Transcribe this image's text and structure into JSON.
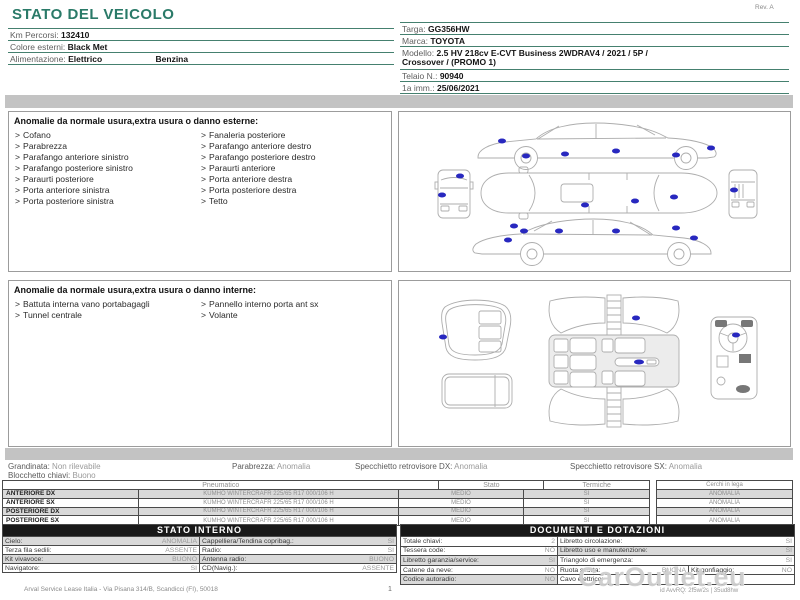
{
  "ui": {
    "bullet": ">"
  },
  "colors": {
    "accent_teal": "#2a7a68",
    "separator_teal": "#45806f",
    "damage_marker_blue": "#2828bf",
    "band_gray": "#c3c3c3",
    "table_header_dark": "#191919",
    "row_gray": "#d9d9d9"
  },
  "header": {
    "title": "STATO DEL VEICOLO",
    "rev": "Rev. A",
    "left_rows": [
      {
        "label": "Km Percorsi:",
        "value": "132410"
      },
      {
        "label": "Colore esterni:",
        "value": "Black Met"
      },
      {
        "label": "Alimentazione:",
        "value": "Elettrico",
        "value2": "Benzina"
      }
    ],
    "right_rows": [
      {
        "label": "Targa:",
        "value": "GG356HW"
      },
      {
        "label": "Marca:",
        "value": "TOYOTA"
      },
      {
        "label": "Modello:",
        "value": "2.5 HV 218cv E-CVT Business 2WDRAV4 / 2021 / 5P /\nCrossover / (PROMO 1)"
      },
      {
        "label": "Telaio N.:",
        "value": "90940"
      },
      {
        "label": "1a imm.:",
        "value": "25/06/2021"
      }
    ]
  },
  "exterior": {
    "heading": "Anomalie da normale usura,extra usura o danno esterne:",
    "col1": [
      "Cofano",
      "Parabrezza",
      "Parafango anteriore sinistro",
      "Parafango posteriore sinistro",
      "Paraurti posteriore",
      "Porta anteriore sinistra",
      "Porta posteriore sinistra"
    ],
    "col2": [
      "Fanaleria posteriore",
      "Parafango anteriore destro",
      "Parafango posteriore destro",
      "Paraurti anteriore",
      "Porta anteriore destra",
      "Porta posteriore destra",
      "Tetto"
    ]
  },
  "interior": {
    "heading": "Anomalie da normale usura,extra usura o danno interne:",
    "col1": [
      "Battuta interna vano portabagagli",
      "Tunnel centrale"
    ],
    "col2": [
      "Pannello interno porta ant sx",
      "Volante"
    ]
  },
  "status_row": {
    "grandinata": {
      "label": "Grandinata:",
      "value": "Non rilevabile"
    },
    "blocchetto": {
      "label": "Blocchetto chiavi:",
      "value": "Buono"
    },
    "parabrezza": {
      "label": "Parabrezza:",
      "value": "Anomalia"
    },
    "specchietto_dx": {
      "label": "Specchietto retrovisore DX:",
      "value": "Anomalia"
    },
    "specchietto_sx": {
      "label": "Specchietto retrovisore SX:",
      "value": "Anomalia"
    }
  },
  "tires": {
    "headers": {
      "pneumatico": "Pneumatico",
      "stato": "Stato",
      "termiche": "Termiche",
      "cerchi": "Cerchi in lega"
    },
    "rows": [
      {
        "position": "ANTERIORE DX",
        "tire": "KUMHO WINTERCRAFR 225/65 R17 000/106 H",
        "stato": "MEDIO",
        "termiche": "SI",
        "cerchi": "ANOMALIA"
      },
      {
        "position": "ANTERIORE SX",
        "tire": "KUMHO WINTERCRAFR 225/65 R17 000/106 H",
        "stato": "MEDIO",
        "termiche": "SI",
        "cerchi": "ANOMALIA"
      },
      {
        "position": "POSTERIORE DX",
        "tire": "KUMHO WINTERCRAFR 225/65 R17 000/106 H",
        "stato": "MEDIO",
        "termiche": "SI",
        "cerchi": "ANOMALIA"
      },
      {
        "position": "POSTERIORE SX",
        "tire": "KUMHO WINTERCRAFR 225/65 R17 000/106 H",
        "stato": "MEDIO",
        "termiche": "SI",
        "cerchi": "ANOMALIA"
      }
    ]
  },
  "stato_interno": {
    "heading": "STATO INTERNO",
    "rows": [
      {
        "l1": "Cielo:",
        "v1": "ANOMALIA",
        "l2": "Cappelliera/Tendina copribag.:",
        "v2": "SI"
      },
      {
        "l1": "Terza fila sedili:",
        "v1": "ASSENTE",
        "l2": "Radio:",
        "v2": "SI"
      },
      {
        "l1": "Kit vivavoce:",
        "v1": "BUONO",
        "l2": "Antenna radio:",
        "v2": "BUONO"
      },
      {
        "l1": "Navigatore:",
        "v1": "SI",
        "l2": "CD(Navig.):",
        "v2": "ASSENTE"
      }
    ]
  },
  "documenti": {
    "heading": "DOCUMENTI E DOTAZIONI",
    "rows": [
      {
        "l1": "Totale chiavi:",
        "v1": "2",
        "l2": "Libretto circolazione:",
        "v2": "SI"
      },
      {
        "l1": "Tessera code:",
        "v1": "NO",
        "l2": "Libretto uso e manutenzione:",
        "v2": "SI"
      },
      {
        "l1": "Libretto garanzia/service:",
        "v1": "SI",
        "l2": "Triangolo di emergenza:",
        "v2": "SI"
      },
      {
        "l1": "Catene da neve:",
        "v1": "NO",
        "l2": "Ruota scorta:",
        "v2": "BUONA",
        "l3": "Kit gonfiaggio:",
        "v3": "NO"
      },
      {
        "l1": "Codice autoradio:",
        "v1": "NO",
        "l2": "Cavo elettrico:",
        "v2": ""
      }
    ]
  },
  "footer": {
    "company": "Arval Service Lease Italia - Via Pisana 314/B, Scandicci (FI), 50018",
    "page": "1",
    "watermark": "CarOutlet.eu",
    "ref": "id AvvRQ: 2f5w/2s | 35ud8hw"
  }
}
